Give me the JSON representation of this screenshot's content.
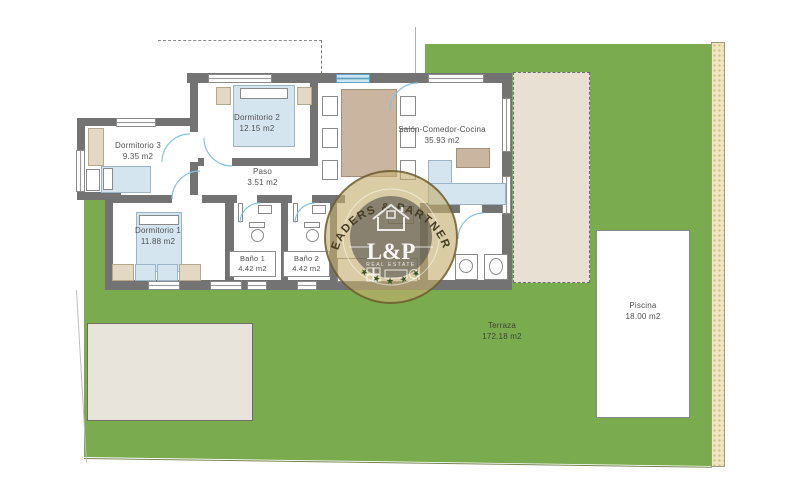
{
  "plan": {
    "rooms": {
      "dormitorio3": {
        "name": "Dormitorio 3",
        "area": "9.35 m2"
      },
      "dormitorio2": {
        "name": "Dormitorio 2",
        "area": "12.15 m2"
      },
      "dormitorio1": {
        "name": "Dormitorio 1",
        "area": "11.88 m2"
      },
      "paso": {
        "name": "Paso",
        "area": "3.51 m2"
      },
      "bano1": {
        "name": "Baño 1",
        "area": "4.42 m2"
      },
      "bano2": {
        "name": "Baño 2",
        "area": "4.42 m2"
      },
      "salon": {
        "name": "Salón-Comedor-Cocina",
        "area": "35.93 m2"
      },
      "terraza": {
        "name": "Terraza",
        "area": "172.18 m2"
      },
      "piscina": {
        "name": "Piscina",
        "area": "18.00 m2"
      }
    },
    "watermark": {
      "arc_text": "LEADERS & PARTNERS",
      "monogram": "L&P",
      "sub_text": "REAL ESTATE",
      "stars": "★ ★ ★ ★ ★"
    },
    "colors": {
      "garden_green": "#7aab4e",
      "wall_gray": "#737373",
      "furniture_blue": "#d5e5f0",
      "furniture_tan": "#c9b5a0",
      "patio_beige": "#e8e0d2",
      "boundary_tan": "#f2e6c2",
      "door_arc_blue": "#85c3dc",
      "watermark_gold": "#c4ae6e"
    }
  }
}
